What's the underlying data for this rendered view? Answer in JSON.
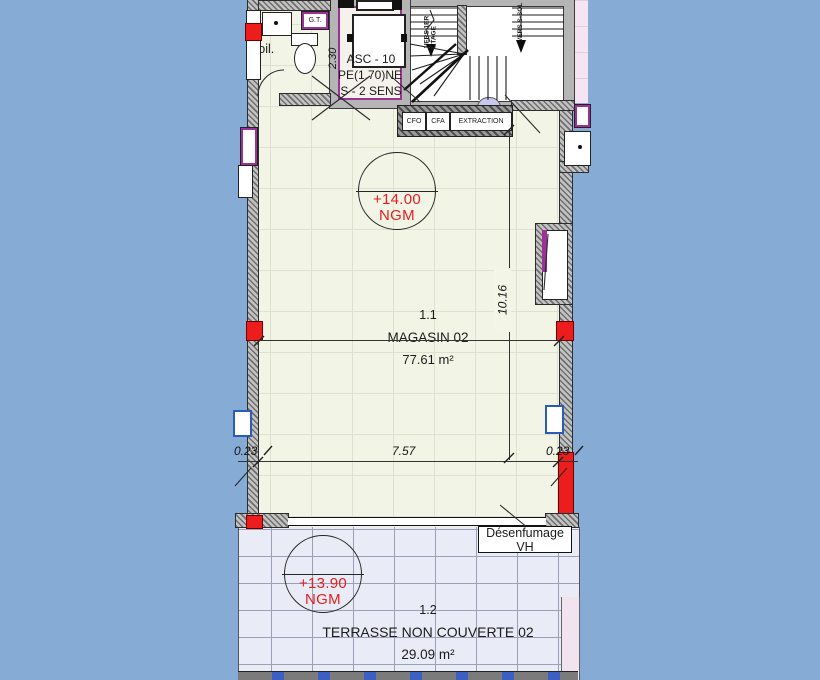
{
  "plan": {
    "rooms": {
      "magasin": {
        "number": "1.1",
        "name": "MAGASIN 02",
        "area": "77.61 m²",
        "level": "+14.00",
        "datum": "NGM"
      },
      "terrasse": {
        "number": "1.2",
        "name": "TERRASSE NON COUVERTE 02",
        "area": "29.09 m²",
        "level": "+13.90",
        "datum": "NGM"
      },
      "toilet": {
        "label": "Toil."
      },
      "gaine": {
        "label": "G.T."
      }
    },
    "elevator": {
      "line1": "ASC - 10",
      "line2": "PE(1.70)NE",
      "line3": "S - 2 SENS",
      "width_dim": "2.30"
    },
    "stairs": {
      "up_label": "VERS 1ER ETAGE",
      "down_label": "VERS S-SOL"
    },
    "equipment": {
      "cfo": "CFO",
      "cfa": "CFA",
      "extraction": "EXTRACTION",
      "smoke_vent": "Désenfumage VH"
    },
    "dimensions": {
      "wall_left": "0.23",
      "width": "7.57",
      "wall_right": "0.23",
      "depth": "10.16"
    },
    "colors": {
      "background": "#86abd4",
      "floor": "#f2f4e6",
      "terrace": "#e9ecf6",
      "wall_red": "#ee1d1d",
      "frame_purple": "#9c3296",
      "level_red": "#e31f1f",
      "pink_zone": "#f6e4f2"
    }
  }
}
